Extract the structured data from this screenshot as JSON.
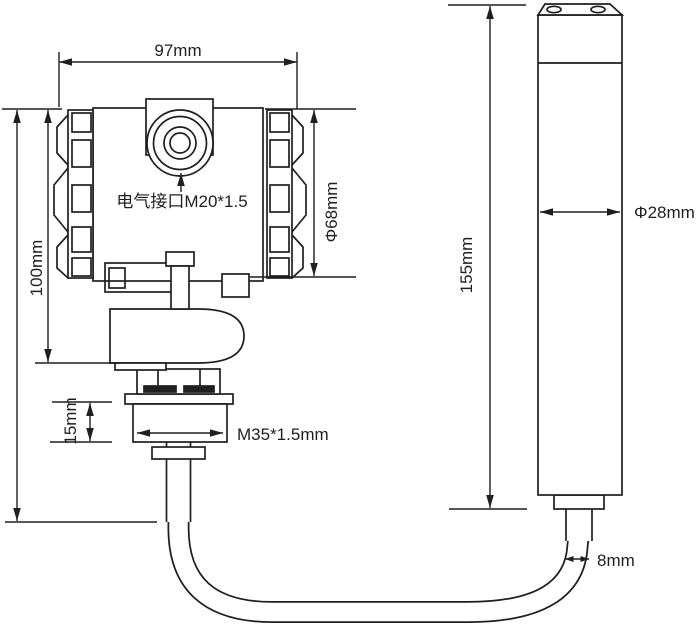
{
  "diagram": {
    "kind": "technical-dimension-drawing",
    "background": "#ffffff",
    "line_color": "#1f1f1f",
    "dimensions": {
      "head_width": "97mm",
      "head_height": "100mm",
      "head_diameter": "Φ68mm",
      "electrical_interface": "电气接口M20*1.5",
      "neck_height": "15mm",
      "mounting_thread": "M35*1.5mm",
      "probe_length": "155mm",
      "probe_diameter": "Φ28mm",
      "cable_diameter": "8mm"
    }
  }
}
